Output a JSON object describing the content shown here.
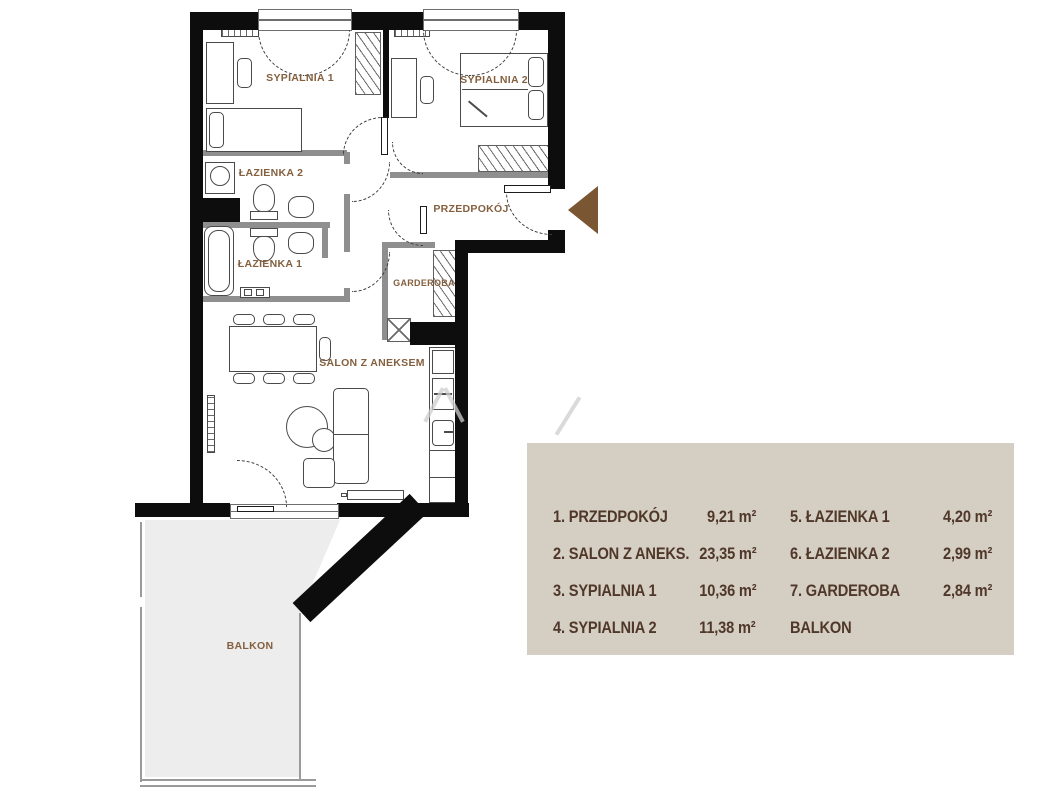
{
  "plan": {
    "rooms": {
      "sypialnia1": "SYPIALNIA 1",
      "sypialnia2": "SYPIALNIA 2",
      "lazienka1": "ŁAZIENKA 1",
      "lazienka2": "ŁAZIENKA 2",
      "przedpokoj": "PRZEDPOKÓJ",
      "garderoba": "GARDEROBA",
      "salon": "SALON Z ANEKSEM",
      "balkon": "BALKON"
    },
    "colors": {
      "walls": "#0d0d0d",
      "thin_walls": "#8f8f8f",
      "room_label": "#84603f",
      "entrance_arrow": "#7b5632",
      "balcony_fill": "#ededed"
    }
  },
  "legend": {
    "background": "#d5cec2",
    "text_color": "#4f382a",
    "rows": [
      {
        "left_label": "1. PRZEDPOKÓJ",
        "left_area": "9,21 m²",
        "right_label": "5. ŁAZIENKA 1",
        "right_area": "4,20 m²"
      },
      {
        "left_label": "2. SALON Z ANEKS.",
        "left_area": "23,35 m²",
        "right_label": "6. ŁAZIENKA 2",
        "right_area": "2,99 m²"
      },
      {
        "left_label": "3. SYPIALNIA 1",
        "left_area": "10,36 m²",
        "right_label": "7. GARDEROBA",
        "right_area": "2,84 m²"
      },
      {
        "left_label": "4. SYPIALNIA 2",
        "left_area": "11,38 m²",
        "right_label": "BALKON",
        "right_area": ""
      }
    ]
  }
}
